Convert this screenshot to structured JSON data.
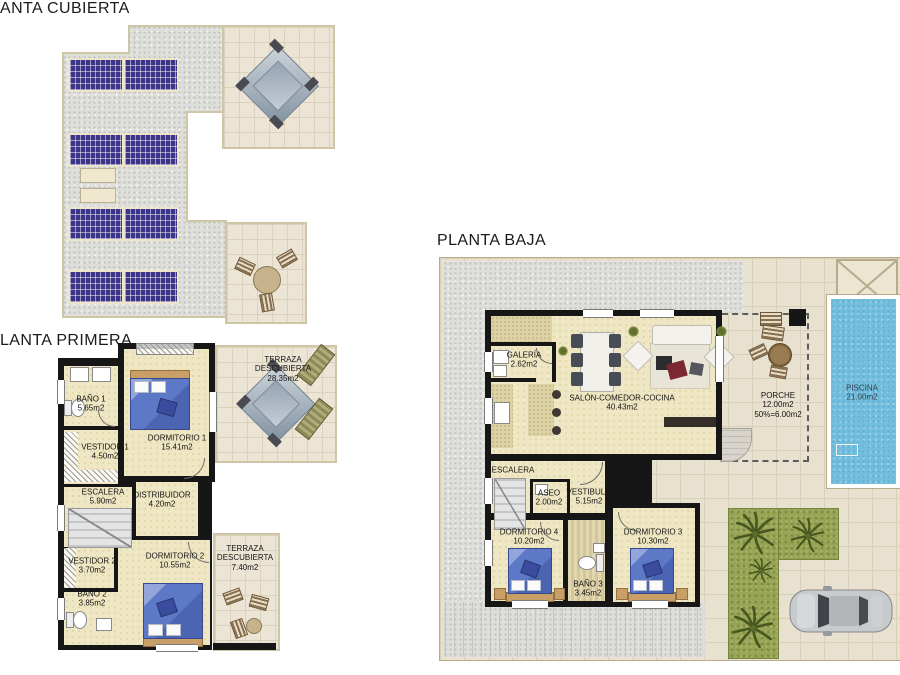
{
  "titles": {
    "cubierta": "ANTA CUBIERTA",
    "primera": "LANTA PRIMERA",
    "baja": "PLANTA BAJA"
  },
  "primera_rooms": [
    {
      "name": "BAÑO 1",
      "area": "5.65m2"
    },
    {
      "name": "VESTIDOR 1",
      "area": "4.50m2"
    },
    {
      "name": "ESCALERA",
      "area": "5.90m2"
    },
    {
      "name": "DISTRIBUIDOR",
      "area": "4.20m2"
    },
    {
      "name": "DORMITORIO 1",
      "area": "15.41m2"
    },
    {
      "name": "DORMITORIO 2",
      "area": "10.55m2"
    },
    {
      "name": "VESTIDOR 2",
      "area": "3.70m2"
    },
    {
      "name": "BAÑO 2",
      "area": "3.85m2"
    },
    {
      "name": "TERRAZA",
      "name2": "DESCUBIERTA",
      "area": "28.35m2"
    },
    {
      "name": "TERRAZA",
      "name2": "DESCUBIERTA",
      "area": "7.40m2"
    }
  ],
  "baja_rooms": [
    {
      "name": "GALERÍA",
      "area": "2.62m2"
    },
    {
      "name": "SALÓN-COMEDOR-COCINA",
      "area": "40.43m2"
    },
    {
      "name": "ESCALERA"
    },
    {
      "name": "ASEO",
      "area": "2.00m2"
    },
    {
      "name": "VESTIBULO",
      "area": "5.15m2"
    },
    {
      "name": "DORMITORIO 4",
      "area": "10.20m2"
    },
    {
      "name": "BAÑO 3",
      "area": "3.45m2"
    },
    {
      "name": "DORMITORIO 3",
      "area": "10.30m2"
    },
    {
      "name": "PORCHE",
      "area": "12.00m2",
      "extra": "50%=6.00m2"
    },
    {
      "name": "PISCINA",
      "area": "21.00m2"
    }
  ],
  "colors": {
    "wall": "#161616",
    "solar_panel": "#3c3488",
    "pool_water": "#74bedd",
    "garden": "#97a355",
    "bed": "#5e78c8",
    "roof_gravel": "#dededa",
    "terrace_tile": "#e9e1cf",
    "interior_floor": "#efe7c3",
    "sofa_accent": "#7c2833"
  }
}
